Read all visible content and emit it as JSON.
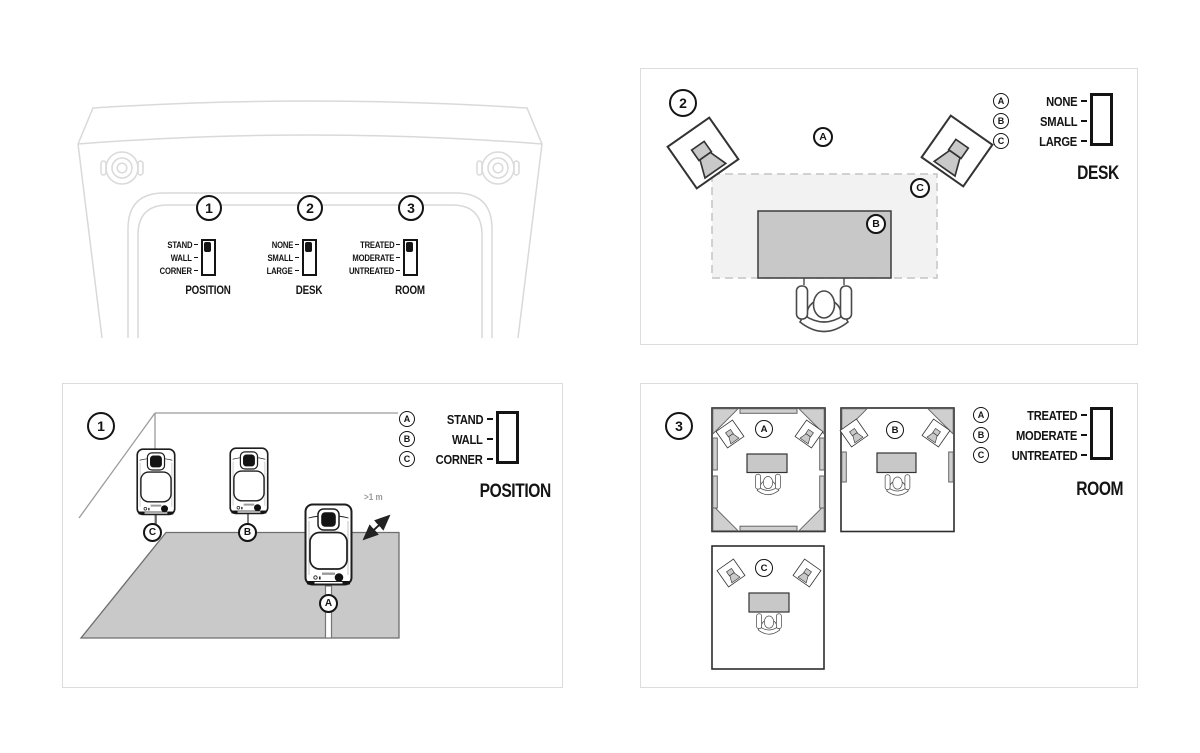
{
  "colors": {
    "ink": "#141414",
    "faint_outline": "#d9d9d9",
    "panel_border": "#dcdcdc",
    "floor_gray": "#c9c9c9",
    "desk_gray": "#c8c8c8",
    "large_desk_area": "#f2f2f2",
    "treatment_gray": "#cfcfcf",
    "note_gray": "#9a9a9a"
  },
  "rear_panel": {
    "switches": [
      {
        "number": "1",
        "caption": "POSITION",
        "options": [
          "STAND",
          "WALL",
          "CORNER"
        ],
        "selected": "STAND"
      },
      {
        "number": "2",
        "caption": "DESK",
        "options": [
          "NONE",
          "SMALL",
          "LARGE"
        ],
        "selected": "NONE"
      },
      {
        "number": "3",
        "caption": "ROOM",
        "options": [
          "TREATED",
          "MODERATE",
          "UNTREATED"
        ],
        "selected": "TREATED"
      }
    ]
  },
  "position_panel": {
    "number": "1",
    "caption": "POSITION",
    "legend": [
      {
        "key": "A",
        "label": "STAND"
      },
      {
        "key": "B",
        "label": "WALL"
      },
      {
        "key": "C",
        "label": "CORNER"
      }
    ],
    "markers": {
      "stand": "A",
      "wall": "B",
      "corner": "C"
    },
    "distance_note": ">1 m"
  },
  "desk_panel": {
    "number": "2",
    "caption": "DESK",
    "legend": [
      {
        "key": "A",
        "label": "NONE"
      },
      {
        "key": "B",
        "label": "SMALL"
      },
      {
        "key": "C",
        "label": "LARGE"
      }
    ],
    "markers": {
      "no_desk": "A",
      "small_desk": "B",
      "large_desk": "C"
    }
  },
  "room_panel": {
    "number": "3",
    "caption": "ROOM",
    "legend": [
      {
        "key": "A",
        "label": "TREATED"
      },
      {
        "key": "B",
        "label": "MODERATE"
      },
      {
        "key": "C",
        "label": "UNTREATED"
      }
    ],
    "markers": {
      "treated": "A",
      "moderate": "B",
      "untreated": "C"
    }
  }
}
